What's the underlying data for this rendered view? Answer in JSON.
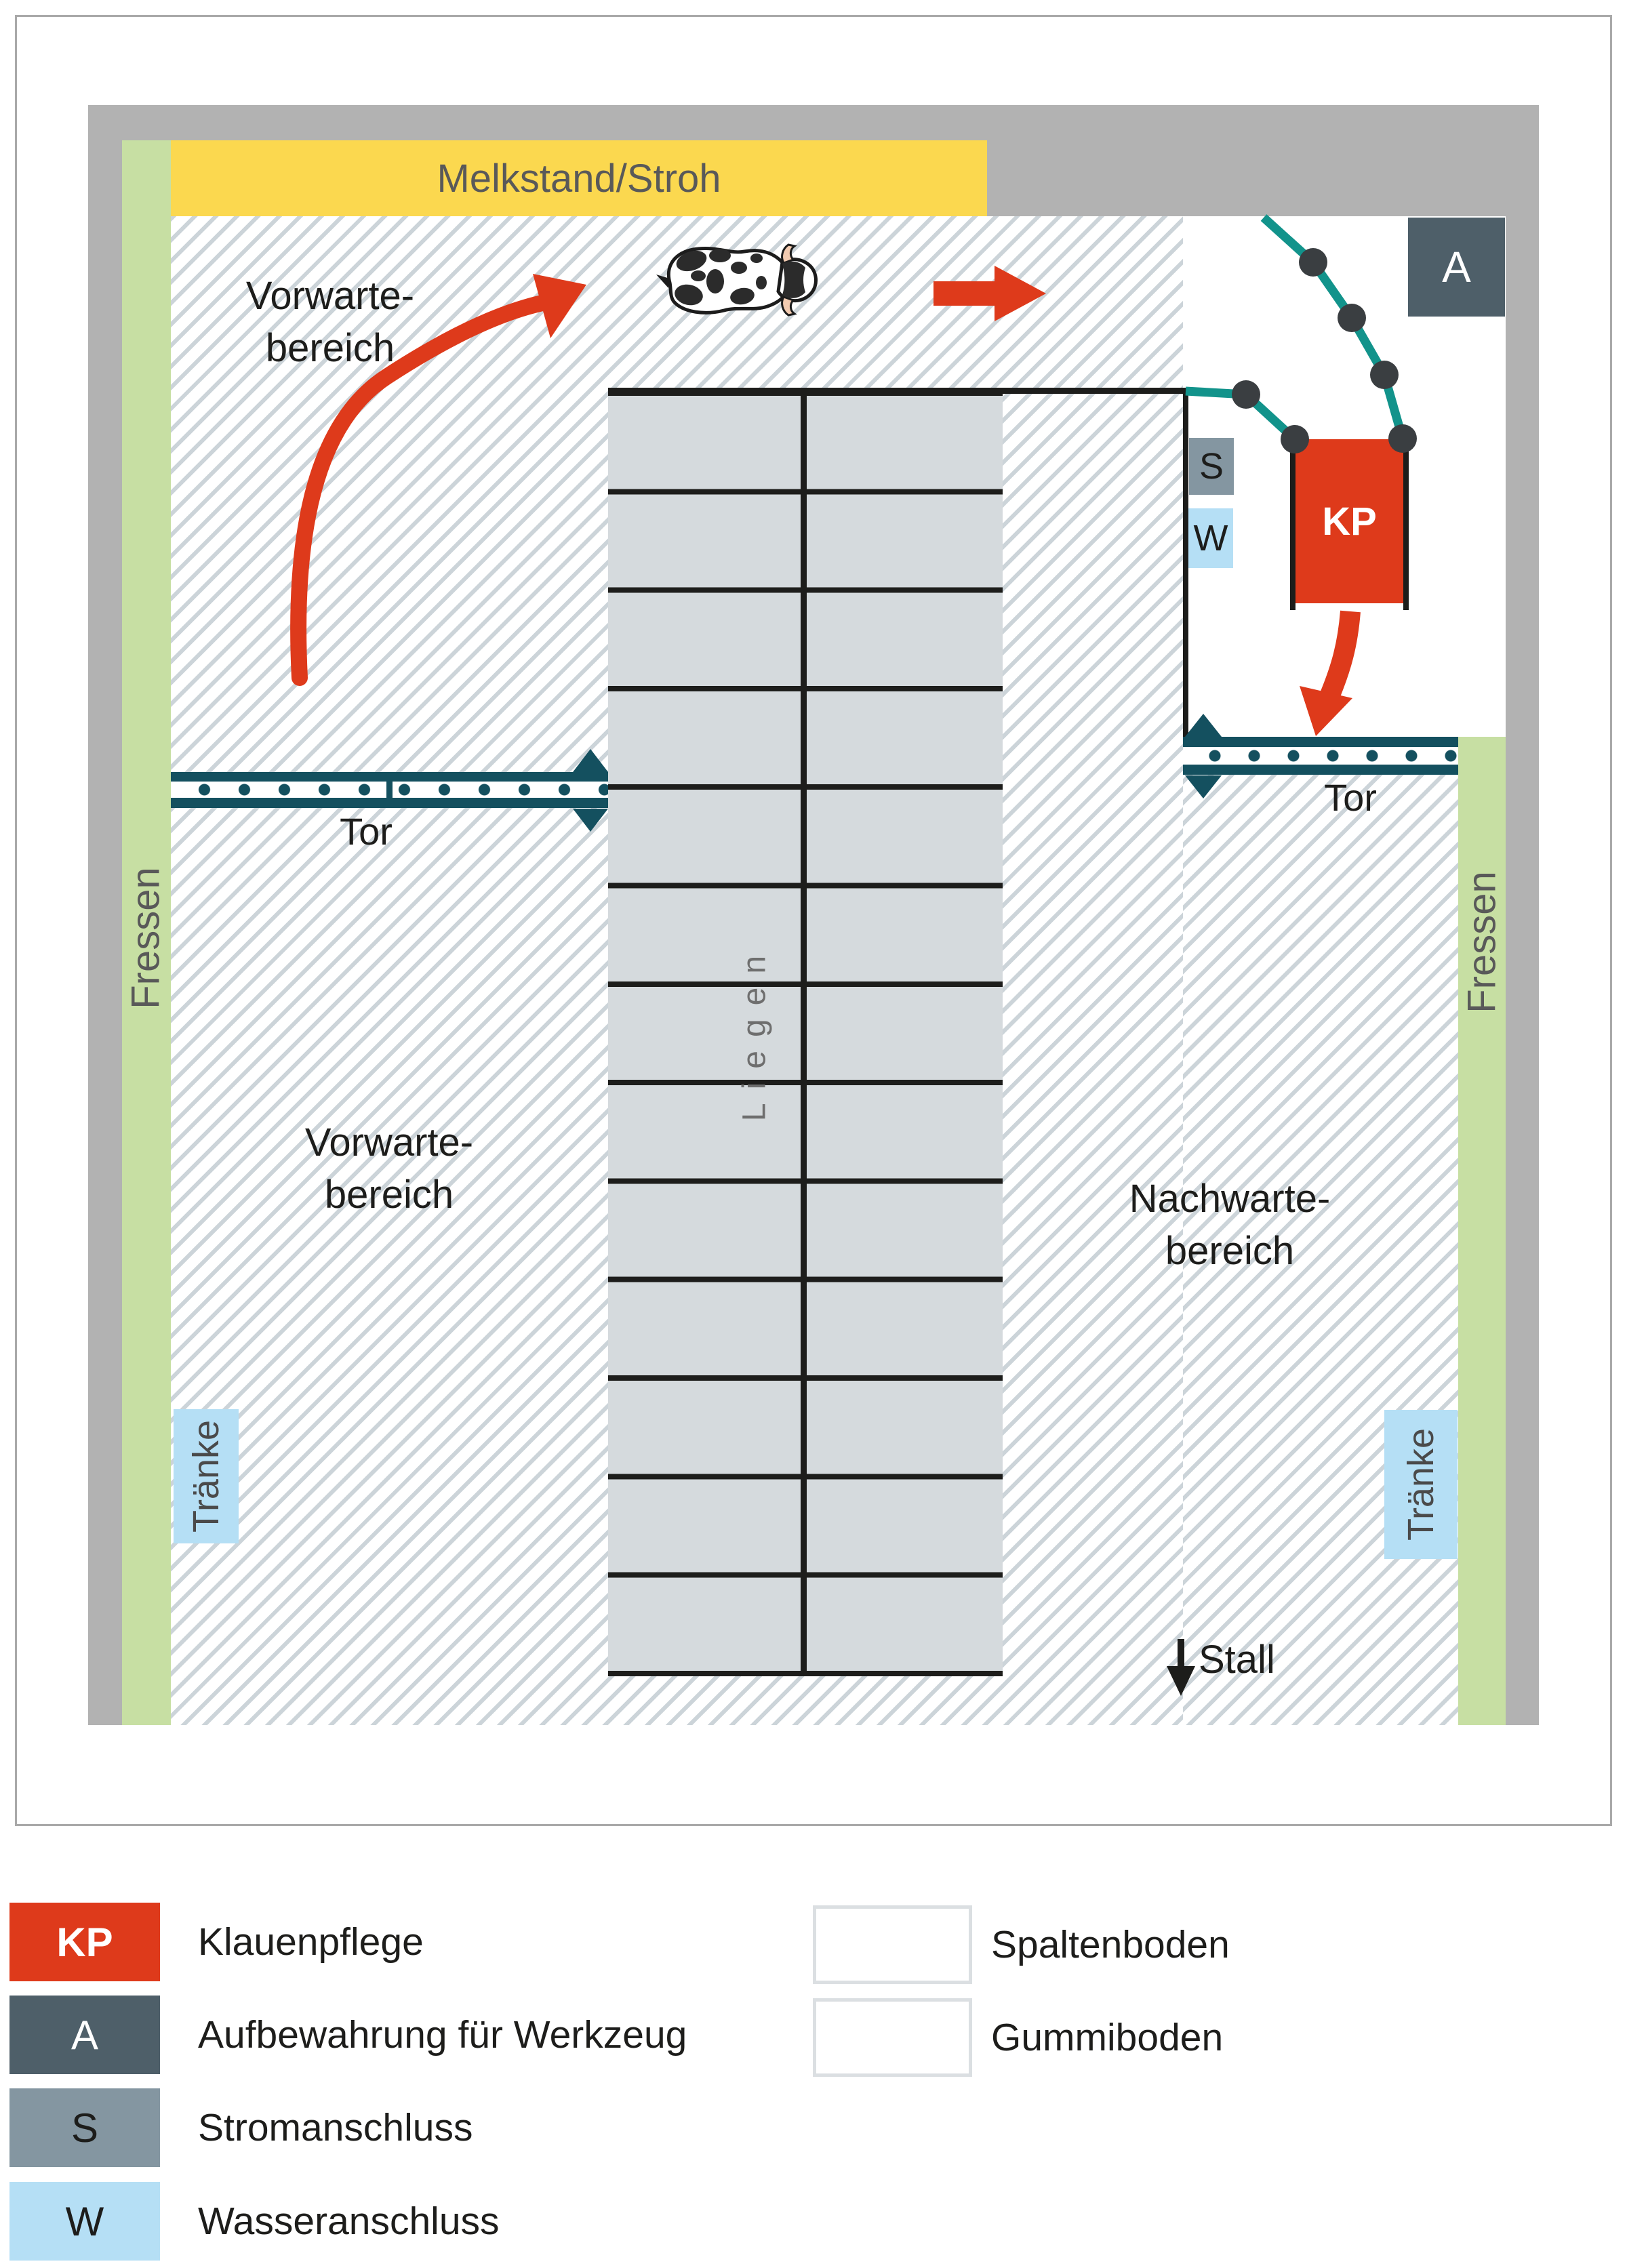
{
  "plan": {
    "melkstand_label": "Melkstand/Stroh",
    "vorwartebereich_top": {
      "line1": "Vorwarte-",
      "line2": "bereich"
    },
    "vorwartebereich_bottom": {
      "line1": "Vorwarte-",
      "line2": "bereich"
    },
    "nachwartebereich": {
      "line1": "Nachwarte-",
      "line2": "bereich"
    },
    "liegen_label": "Liegen",
    "fressen_left": "Fressen",
    "fressen_right": "Fressen",
    "traenke_left": "Tränke",
    "traenke_right": "Tränke",
    "tor_left": "Tor",
    "tor_right": "Tor",
    "stall_label": "Stall",
    "kp_label": "KP",
    "a_label": "A",
    "s_label": "S",
    "w_label": "W",
    "grid": {
      "rows": 13,
      "columns": 2
    }
  },
  "legend": {
    "items": [
      {
        "key": "KP",
        "label": "Klauenpflege"
      },
      {
        "key": "A",
        "label": "Aufbewahrung für Werkzeug"
      },
      {
        "key": "S",
        "label": "Stromanschluss"
      },
      {
        "key": "W",
        "label": "Wasseranschluss"
      }
    ],
    "floor_items": [
      {
        "label": "Spaltenboden"
      },
      {
        "label": "Gummiboden"
      }
    ]
  },
  "colors": {
    "kp_red": "#de3a1b",
    "tool_storage_slate": "#4e5f69",
    "power_gray": "#8496a1",
    "water_blue": "#b5dff5",
    "melkstand_yellow": "#fbd84f",
    "feeding_green": "#c7dfa3",
    "wall_gray": "#b2b2b2",
    "fence_teal": "#12938b",
    "gate_dark_teal": "#14505f",
    "stall_cell_gray": "#d5dadd",
    "hatch_line_gray": "#ccd4d9"
  }
}
